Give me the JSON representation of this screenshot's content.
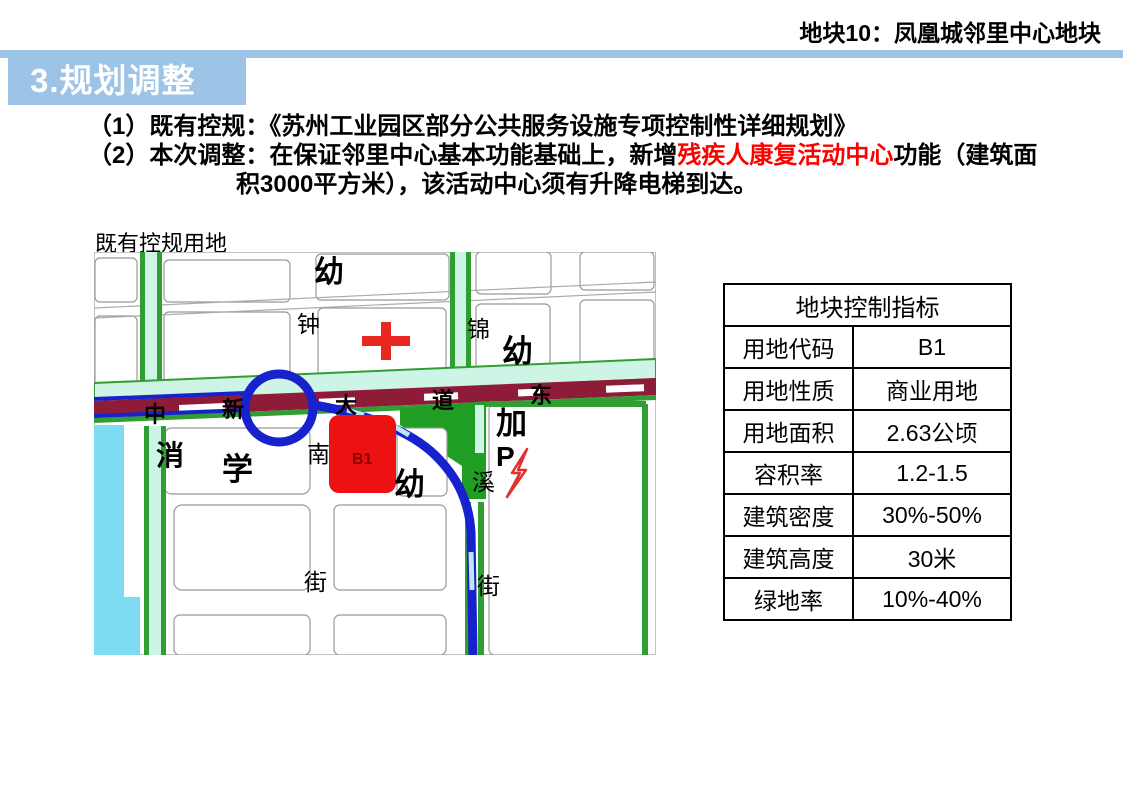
{
  "header": {
    "plot_label": "地块10：凤凰城邻里中心地块"
  },
  "section": {
    "title": "3.规划调整"
  },
  "notes": {
    "line1_prefix": "（1）既有控规：",
    "line1_text": "《苏州工业园区部分公共服务设施专项控制性详细规划》",
    "line2_prefix": "（2）本次调整：",
    "line2_before": "在保证邻里中心基本功能基础上，新增",
    "line2_highlight": "残疾人康复活动中心",
    "line2_after": "功能（建筑面",
    "line3": "积3000平方米），该活动中心须有升降电梯到达。"
  },
  "map": {
    "caption": "既有控规用地",
    "parcel_code": "B1",
    "labels": {
      "kindergarten_top": "幼",
      "zhong": "钟",
      "jin": "锦",
      "kindergarten_right": "幼",
      "xiao": "消",
      "xue": "学",
      "nan": "南",
      "kindergarten_south": "幼",
      "xi": "溪",
      "jia": "加",
      "parking": "P",
      "jie_left": "街",
      "jie_right": "街",
      "road_zhong": "中",
      "road_xin": "新",
      "road_da": "大",
      "road_dao": "道",
      "road_dong": "东"
    }
  },
  "table": {
    "title": "地块控制指标",
    "rows": [
      {
        "label": "用地代码",
        "value": "B1"
      },
      {
        "label": "用地性质",
        "value": "商业用地"
      },
      {
        "label": "用地面积",
        "value": "2.63公顷"
      },
      {
        "label": "容积率",
        "value": "1.2-1.5"
      },
      {
        "label": "建筑密度",
        "value": "30%-50%"
      },
      {
        "label": "建筑高度",
        "value": "30米"
      },
      {
        "label": "绿地率",
        "value": "10%-40%"
      }
    ]
  },
  "colors": {
    "accent_blue": "#9DC3E6",
    "highlight_red": "#FF0000",
    "road_maroon": "#8E1C38",
    "metro_blue": "#1822CC",
    "park_green": "#1F9E23",
    "street_edge_green": "#2F9E33",
    "street_cyan": "#CDF4E4",
    "water_cyan": "#7EDCF2",
    "parcel_red": "#EE1111"
  }
}
